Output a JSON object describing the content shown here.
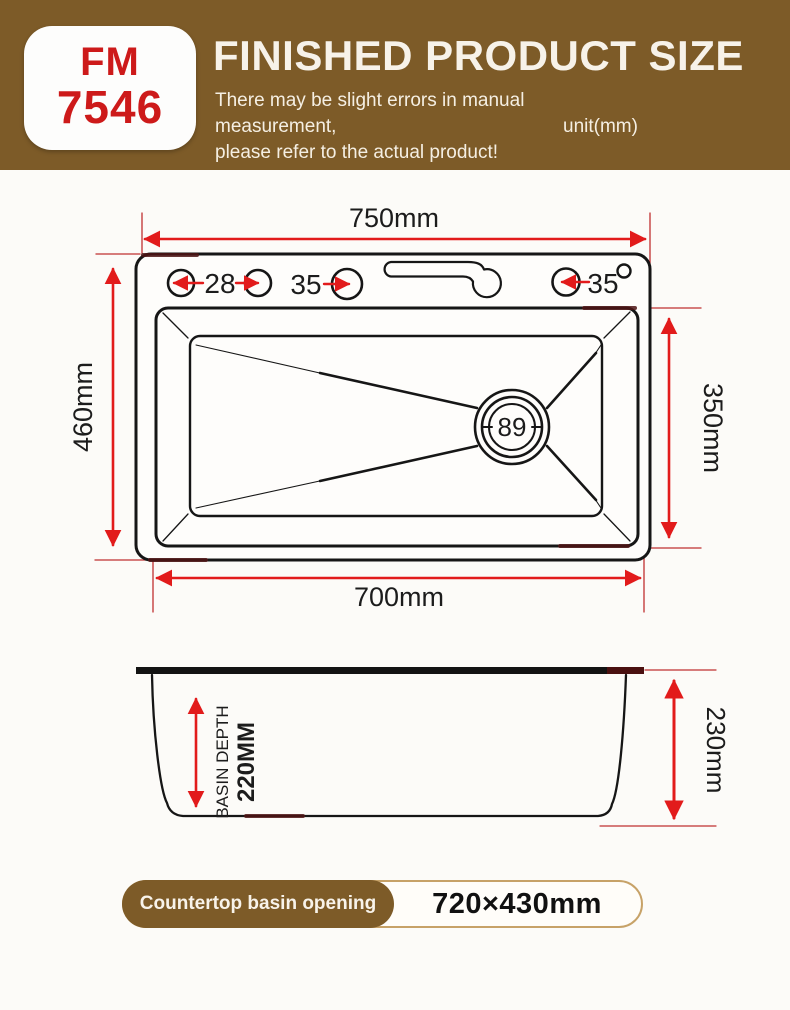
{
  "header": {
    "model_line1": "FM",
    "model_line2": "7546",
    "title": "FINISHED PRODUCT SIZE",
    "subtitle_line1": "There may be slight errors in manual measurement,",
    "subtitle_line2": "please refer to the actual product!",
    "unit_label": "unit(mm)"
  },
  "top_view": {
    "overall_width": "750mm",
    "overall_depth": "460mm",
    "basin_width": "700mm",
    "basin_depth_dim": "350mm",
    "hole_left": "28",
    "hole_middle": "35",
    "hole_right": "35",
    "drain_diameter": "89"
  },
  "side_view": {
    "basin_depth_line1": "BASIN DEPTH",
    "basin_depth_line2": "220MM",
    "overall_height": "230mm"
  },
  "footer": {
    "badge_label": "Countertop basin opening",
    "badge_value": "720×430mm"
  },
  "colors": {
    "header_brown": "#7d5b28",
    "model_red": "#cd1a1a",
    "dimension_red": "#e21b1b",
    "extension_red": "#c03030",
    "outline_black": "#161616"
  }
}
